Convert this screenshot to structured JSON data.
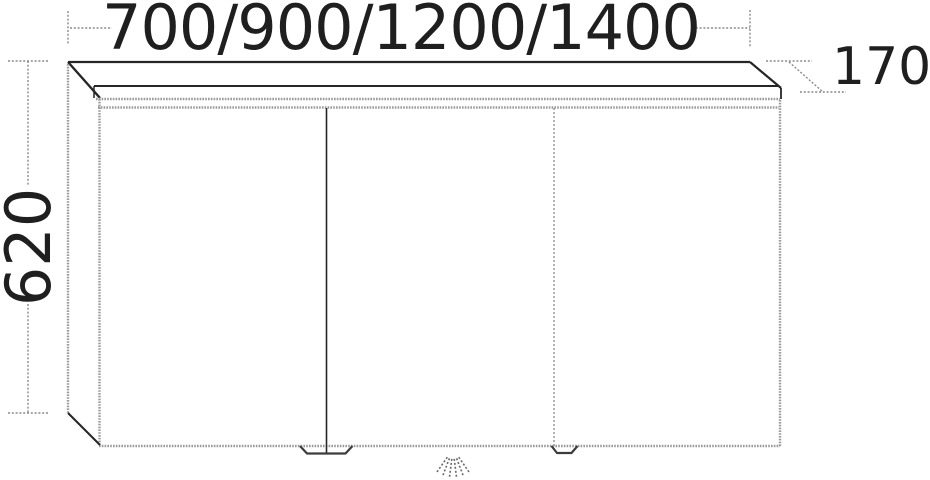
{
  "dimensions": {
    "width_options_mm": "700/900/1200/1400",
    "height_mm": "620",
    "depth_mm": "170"
  },
  "cabinet": {
    "door_count": 3
  },
  "icons": {
    "bottom_center": "light-rays-icon"
  },
  "colors": {
    "line_black": "#262626",
    "edge_grey": "#9a9a9a",
    "dim_grey": "#8a8a8a",
    "background": "#ffffff"
  }
}
